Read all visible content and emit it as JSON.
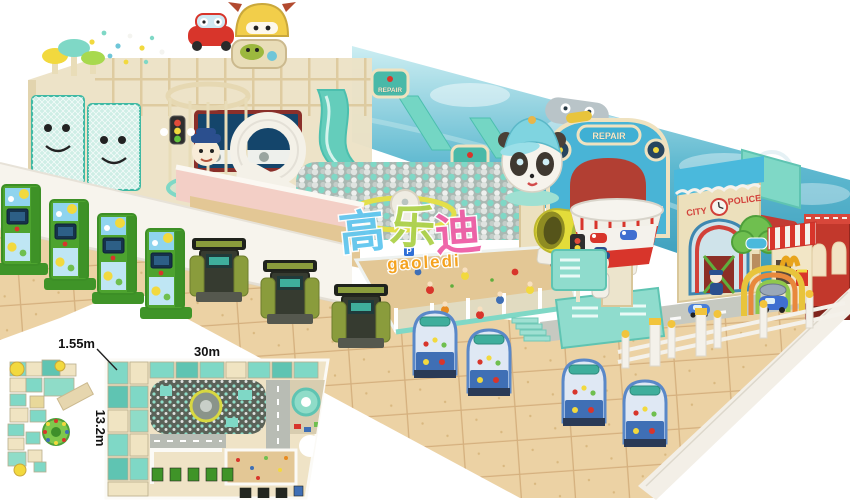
{
  "image": {
    "kind": "3D render of a car/city themed indoor kids playground with arcade machines, ball pit, sand pits and a top-view floor plan inset",
    "background": "#ffffff"
  },
  "watermark": {
    "characters": [
      {
        "text": "高",
        "color": "#62c7f0"
      },
      {
        "text": "乐",
        "color": "#aed24b"
      },
      {
        "text": "迪",
        "color": "#ef5ea6"
      }
    ],
    "subtitle": "gaoledi",
    "subtitle_color": "#f6a21c"
  },
  "dimensions": {
    "wall": "1.55m",
    "width": "30m",
    "depth": "13.2m"
  },
  "signs": {
    "repair": "REPAIR",
    "city": "CITY",
    "police": "POLICE",
    "parking": "P"
  },
  "colors": {
    "mint": "#7fd8c6",
    "mintDark": "#3fb9a4",
    "mintLight": "#a9e4d6",
    "cream": "#f0e4c2",
    "creamDark": "#d9c79a",
    "floor": "#ecd2a4",
    "grout": "#c2945f",
    "wallWhite": "#f7f4ed",
    "pink": "#f3cfc6",
    "sand": "#e3c795",
    "red": "#d8352b",
    "yellow": "#f2d93e",
    "backdropTop": "#cdeef2",
    "backdropMid": "#5fb9d0",
    "backdropDeep": "#2e93b4",
    "greenMachine": "#4da32f",
    "kioskDark": "#363b30",
    "olive": "#8a9c3c",
    "clawBlue": "#3f6fb5",
    "skyBlue": "#8fd4ee",
    "slate": "#5a6258",
    "logoBlue": "#62c7f0",
    "logoGreen": "#aed24b",
    "logoPink": "#ef5ea6",
    "logoOrange": "#f6a21c"
  }
}
